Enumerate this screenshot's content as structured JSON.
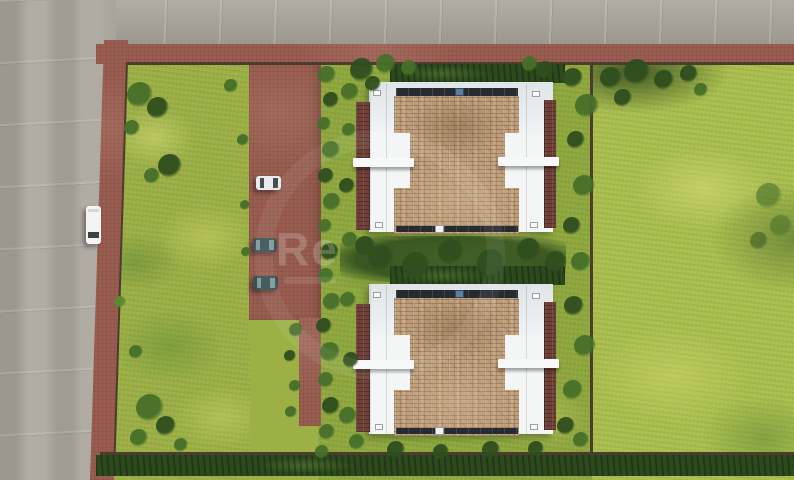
{
  "meta": {
    "description": "Top-down aerial 3D architectural render of a residential plot: two detached houses with tan shingle roofs and white flat-roof wings, brown paved driveway with parked cars, lawns, hedges, perimeter fences, gray asphalt roads on the top and left with a white van"
  },
  "watermark": {
    "text": "Re"
  },
  "palette": {
    "roadGray": "#a8a49b",
    "pavementBrown": "#995e51",
    "grassBase": "#9cb046",
    "grassMain": "#8fa83e",
    "grassRight": "#aabf4e",
    "grassDeep": "#3f6128",
    "hedgeDark": "#2c4a1d",
    "shingleTan": "#c2a17d",
    "roofBrown": "#6e4037",
    "whiteRoof": "#edf0f1",
    "canopyWhite": "#f7f8f9",
    "gutterDark": "#262b31",
    "fenceBrown": "#4c3c2c",
    "ventBlue": "#5d7d9d"
  },
  "scene": {
    "roads": [
      {
        "label": "asphalt road, top, horizontal"
      },
      {
        "label": "asphalt road, left, vertical"
      }
    ],
    "houses": [
      {
        "label": "house-north",
        "x": 356,
        "y": 76
      },
      {
        "label": "house-south",
        "x": 356,
        "y": 278
      }
    ],
    "cars": [
      {
        "label": "white-van-on-road",
        "x": 86,
        "y": 206,
        "w": 15,
        "h": 38,
        "body": "#f4f5f3",
        "glass": "#3c4146",
        "orient": "v"
      },
      {
        "label": "white-car-driveway",
        "x": 256,
        "y": 176,
        "w": 25,
        "h": 14,
        "body": "#e9ecec",
        "glass": "#474e52",
        "orient": "h"
      },
      {
        "label": "teal-car-driveway-1",
        "x": 253,
        "y": 238,
        "w": 24,
        "h": 14,
        "body": "#3d5355",
        "glass": "#7d989b",
        "orient": "h"
      },
      {
        "label": "teal-car-driveway-2",
        "x": 253,
        "y": 276,
        "w": 25,
        "h": 14,
        "body": "#3a5052",
        "glass": "#7d989b",
        "orient": "h"
      }
    ],
    "bushes": [
      {
        "x": 140,
        "y": 95,
        "r": 13,
        "c": "#466f29"
      },
      {
        "x": 158,
        "y": 108,
        "r": 11,
        "c": "#2f4e1e"
      },
      {
        "x": 132,
        "y": 128,
        "r": 8,
        "c": "#466f29"
      },
      {
        "x": 170,
        "y": 166,
        "r": 12,
        "c": "#2f4e1e"
      },
      {
        "x": 152,
        "y": 176,
        "r": 8,
        "c": "#466f29"
      },
      {
        "x": 231,
        "y": 86,
        "r": 7,
        "c": "#466f29"
      },
      {
        "x": 243,
        "y": 140,
        "r": 6,
        "c": "#466f29"
      },
      {
        "x": 245,
        "y": 205,
        "r": 5,
        "c": "#466f29"
      },
      {
        "x": 246,
        "y": 252,
        "r": 5,
        "c": "#466f29"
      },
      {
        "x": 150,
        "y": 408,
        "r": 14,
        "c": "#466f29"
      },
      {
        "x": 166,
        "y": 426,
        "r": 10,
        "c": "#2f4e1e"
      },
      {
        "x": 139,
        "y": 438,
        "r": 9,
        "c": "#466f29"
      },
      {
        "x": 181,
        "y": 445,
        "r": 7,
        "c": "#466f29"
      },
      {
        "x": 120,
        "y": 302,
        "r": 6,
        "c": "#5d8a33"
      },
      {
        "x": 136,
        "y": 352,
        "r": 7,
        "c": "#466f29"
      },
      {
        "x": 327,
        "y": 75,
        "r": 9,
        "c": "#466f29"
      },
      {
        "x": 331,
        "y": 100,
        "r": 8,
        "c": "#2f4e1e"
      },
      {
        "x": 324,
        "y": 124,
        "r": 7,
        "c": "#466f29"
      },
      {
        "x": 331,
        "y": 150,
        "r": 9,
        "c": "#466f29"
      },
      {
        "x": 326,
        "y": 176,
        "r": 8,
        "c": "#2f4e1e"
      },
      {
        "x": 332,
        "y": 202,
        "r": 9,
        "c": "#466f29"
      },
      {
        "x": 325,
        "y": 226,
        "r": 7,
        "c": "#466f29"
      },
      {
        "x": 330,
        "y": 252,
        "r": 9,
        "c": "#2f4e1e"
      },
      {
        "x": 326,
        "y": 276,
        "r": 8,
        "c": "#466f29"
      },
      {
        "x": 332,
        "y": 302,
        "r": 9,
        "c": "#466f29"
      },
      {
        "x": 324,
        "y": 326,
        "r": 8,
        "c": "#2f4e1e"
      },
      {
        "x": 330,
        "y": 352,
        "r": 10,
        "c": "#466f29"
      },
      {
        "x": 326,
        "y": 380,
        "r": 8,
        "c": "#466f29"
      },
      {
        "x": 331,
        "y": 406,
        "r": 9,
        "c": "#2f4e1e"
      },
      {
        "x": 327,
        "y": 432,
        "r": 8,
        "c": "#466f29"
      },
      {
        "x": 322,
        "y": 452,
        "r": 7,
        "c": "#466f29"
      },
      {
        "x": 296,
        "y": 330,
        "r": 7,
        "c": "#466f29"
      },
      {
        "x": 290,
        "y": 356,
        "r": 6,
        "c": "#2f4e1e"
      },
      {
        "x": 295,
        "y": 386,
        "r": 6,
        "c": "#466f29"
      },
      {
        "x": 291,
        "y": 412,
        "r": 6,
        "c": "#466f29"
      },
      {
        "x": 362,
        "y": 70,
        "r": 12,
        "c": "#2f4e1e"
      },
      {
        "x": 386,
        "y": 64,
        "r": 10,
        "c": "#466f29"
      },
      {
        "x": 409,
        "y": 68,
        "r": 8,
        "c": "#466f29"
      },
      {
        "x": 350,
        "y": 92,
        "r": 9,
        "c": "#466f29"
      },
      {
        "x": 373,
        "y": 84,
        "r": 8,
        "c": "#2f4e1e"
      },
      {
        "x": 545,
        "y": 70,
        "r": 9,
        "c": "#2f4e1e"
      },
      {
        "x": 530,
        "y": 64,
        "r": 8,
        "c": "#466f29"
      },
      {
        "x": 349,
        "y": 130,
        "r": 7,
        "c": "#466f29"
      },
      {
        "x": 347,
        "y": 186,
        "r": 8,
        "c": "#2f4e1e"
      },
      {
        "x": 350,
        "y": 240,
        "r": 8,
        "c": "#466f29"
      },
      {
        "x": 348,
        "y": 300,
        "r": 8,
        "c": "#466f29"
      },
      {
        "x": 351,
        "y": 360,
        "r": 8,
        "c": "#2f4e1e"
      },
      {
        "x": 348,
        "y": 416,
        "r": 9,
        "c": "#466f29"
      },
      {
        "x": 357,
        "y": 442,
        "r": 8,
        "c": "#466f29"
      },
      {
        "x": 573,
        "y": 78,
        "r": 10,
        "c": "#2f4e1e"
      },
      {
        "x": 587,
        "y": 106,
        "r": 12,
        "c": "#466f29"
      },
      {
        "x": 576,
        "y": 140,
        "r": 9,
        "c": "#2f4e1e"
      },
      {
        "x": 584,
        "y": 186,
        "r": 11,
        "c": "#466f29"
      },
      {
        "x": 572,
        "y": 226,
        "r": 9,
        "c": "#2f4e1e"
      },
      {
        "x": 581,
        "y": 262,
        "r": 10,
        "c": "#466f29"
      },
      {
        "x": 574,
        "y": 306,
        "r": 10,
        "c": "#2f4e1e"
      },
      {
        "x": 585,
        "y": 346,
        "r": 11,
        "c": "#466f29"
      },
      {
        "x": 573,
        "y": 390,
        "r": 10,
        "c": "#466f29"
      },
      {
        "x": 566,
        "y": 426,
        "r": 9,
        "c": "#2f4e1e"
      },
      {
        "x": 581,
        "y": 440,
        "r": 8,
        "c": "#466f29"
      },
      {
        "x": 365,
        "y": 246,
        "r": 10,
        "c": "#2f4e1e"
      },
      {
        "x": 381,
        "y": 258,
        "r": 13,
        "c": "#2f4e1e"
      },
      {
        "x": 416,
        "y": 266,
        "r": 14,
        "c": "#2f4e1e"
      },
      {
        "x": 451,
        "y": 252,
        "r": 13,
        "c": "#2f4e1e"
      },
      {
        "x": 491,
        "y": 263,
        "r": 14,
        "c": "#2f4e1e"
      },
      {
        "x": 529,
        "y": 250,
        "r": 12,
        "c": "#2f4e1e"
      },
      {
        "x": 556,
        "y": 262,
        "r": 11,
        "c": "#2f4e1e"
      },
      {
        "x": 396,
        "y": 450,
        "r": 9,
        "c": "#2f4e1e"
      },
      {
        "x": 441,
        "y": 452,
        "r": 8,
        "c": "#2f4e1e"
      },
      {
        "x": 491,
        "y": 450,
        "r": 9,
        "c": "#2f4e1e"
      },
      {
        "x": 536,
        "y": 449,
        "r": 8,
        "c": "#2f4e1e"
      },
      {
        "x": 611,
        "y": 78,
        "r": 11,
        "c": "#2f4e1e"
      },
      {
        "x": 637,
        "y": 72,
        "r": 13,
        "c": "#2f4e1e"
      },
      {
        "x": 664,
        "y": 80,
        "r": 10,
        "c": "#2f4e1e"
      },
      {
        "x": 689,
        "y": 74,
        "r": 9,
        "c": "#2f4e1e"
      },
      {
        "x": 623,
        "y": 98,
        "r": 9,
        "c": "#2f4e1e"
      },
      {
        "x": 701,
        "y": 90,
        "r": 7,
        "c": "#466f29"
      },
      {
        "x": 769,
        "y": 196,
        "r": 13,
        "c": "#466f29",
        "o": 0.6
      },
      {
        "x": 781,
        "y": 226,
        "r": 11,
        "c": "#466f29",
        "o": 0.55
      },
      {
        "x": 759,
        "y": 241,
        "r": 9,
        "c": "#2f4e1e",
        "o": 0.5
      }
    ]
  }
}
